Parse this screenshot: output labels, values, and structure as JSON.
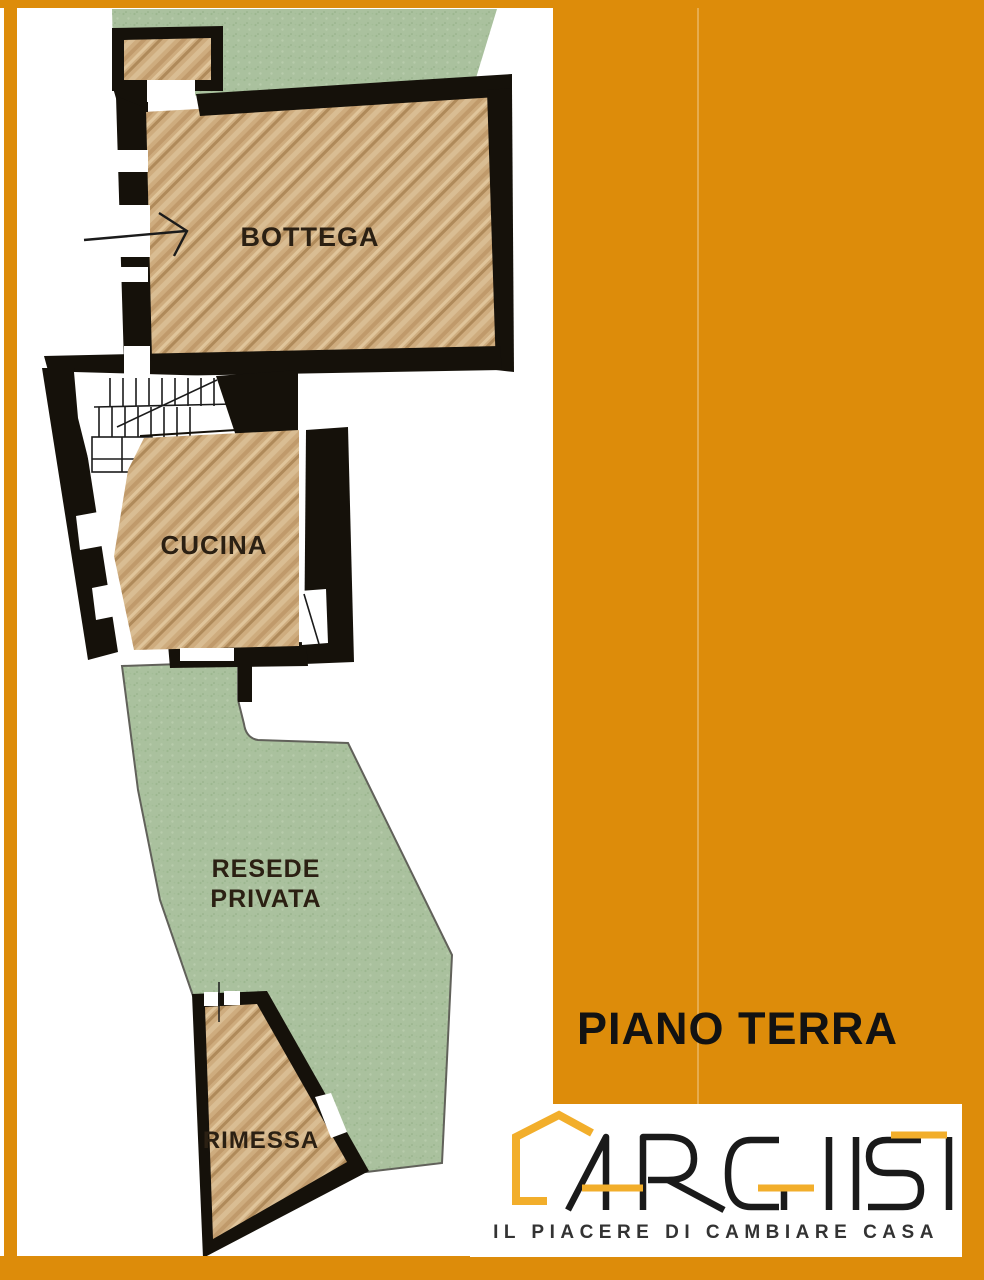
{
  "page": {
    "background": "#FFFFFF",
    "frame_color": "#DD8C0A"
  },
  "side_panel": {
    "title": "PIANO TERRA",
    "color": "#DD8C0A",
    "title_color": "#121212"
  },
  "floor_plan": {
    "rooms": [
      {
        "id": "bottega",
        "label": "BOTTEGA"
      },
      {
        "id": "cucina",
        "label": "CUCINA"
      },
      {
        "id": "resede_privata",
        "label_line1": "RESEDE",
        "label_line2": "PRIVATA"
      },
      {
        "id": "rimessa",
        "label": "RIMESSA"
      }
    ],
    "colors": {
      "wall": "#15110A",
      "wood": "#CEAC7E",
      "grass": "#AAC19E",
      "label": "#2B2013"
    }
  },
  "logo": {
    "brand": "ARCHIST",
    "tagline": "IL PIACERE DI CAMBIARE CASA",
    "accent_color": "#F2AE2B",
    "letter_color": "#1A1A1A",
    "tagline_color": "#333333"
  }
}
